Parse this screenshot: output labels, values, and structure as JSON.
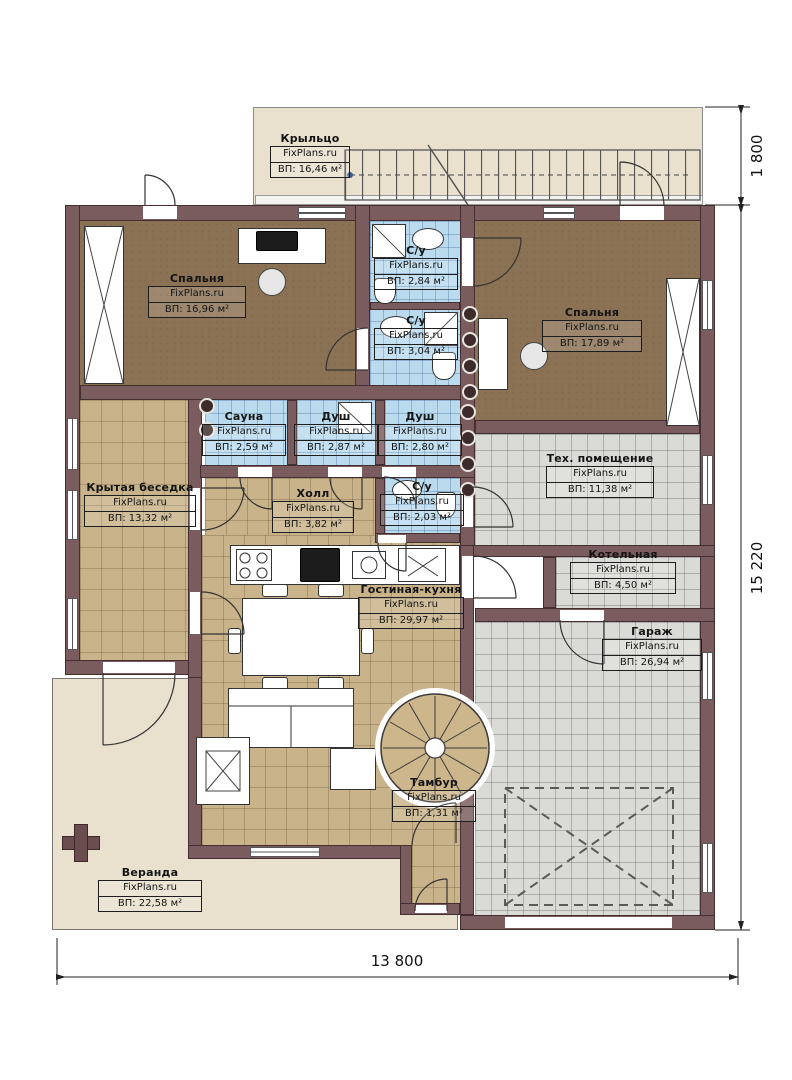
{
  "plan": {
    "brand": "FixPlans.ru",
    "rooms": [
      {
        "id": "porch",
        "name": "Крыльцо",
        "brand": "FixPlans.ru",
        "area": "ВП: 16,46 м²"
      },
      {
        "id": "bedroom-left",
        "name": "Спальня",
        "brand": "FixPlans.ru",
        "area": "ВП: 16,96 м²"
      },
      {
        "id": "wc-top",
        "name": "С/у",
        "brand": "FixPlans.ru",
        "area": "ВП: 2,84 м²"
      },
      {
        "id": "wc-mid",
        "name": "С/у",
        "brand": "FixPlans.ru",
        "area": "ВП: 3,04 м²"
      },
      {
        "id": "bedroom-right",
        "name": "Спальня",
        "brand": "FixPlans.ru",
        "area": "ВП: 17,89 м²"
      },
      {
        "id": "sauna",
        "name": "Сауна",
        "brand": "FixPlans.ru",
        "area": "ВП: 2,59 м²"
      },
      {
        "id": "shower-1",
        "name": "Душ",
        "brand": "FixPlans.ru",
        "area": "ВП: 2,87 м²"
      },
      {
        "id": "shower-2",
        "name": "Душ",
        "brand": "FixPlans.ru",
        "area": "ВП: 2,80 м²"
      },
      {
        "id": "tech",
        "name": "Тех. помещение",
        "brand": "FixPlans.ru",
        "area": "ВП: 11,38 м²"
      },
      {
        "id": "gazebo",
        "name": "Крытая беседка",
        "brand": "FixPlans.ru",
        "area": "ВП: 13,32 м²"
      },
      {
        "id": "hall",
        "name": "Холл",
        "brand": "FixPlans.ru",
        "area": "ВП: 3,82 м²"
      },
      {
        "id": "wc-hall",
        "name": "С/у",
        "brand": "FixPlans.ru",
        "area": "ВП: 2,03 м²"
      },
      {
        "id": "boiler",
        "name": "Котельная",
        "brand": "FixPlans.ru",
        "area": "ВП: 4,50 м²"
      },
      {
        "id": "living",
        "name": "Гостиная-кухня",
        "brand": "FixPlans.ru",
        "area": "ВП: 29,97 м²"
      },
      {
        "id": "garage",
        "name": "Гараж",
        "brand": "FixPlans.ru",
        "area": "ВП: 26,94 м²"
      },
      {
        "id": "tambour",
        "name": "Тамбур",
        "brand": "FixPlans.ru",
        "area": "ВП: 1,31 м²"
      },
      {
        "id": "veranda",
        "name": "Веранда",
        "brand": "FixPlans.ru",
        "area": "ВП: 22,58 м²"
      }
    ],
    "dimensions": {
      "top_right": "1 800",
      "right": "15 220",
      "bottom": "13 800"
    },
    "colors": {
      "wall": "#7b5c5e",
      "wood_floor": "#8b7254",
      "wood_light": "#c9b38a",
      "tile_blue": "#badaed",
      "tile_grey": "#dadbd7",
      "outdoor": "#e9e0cd"
    }
  }
}
